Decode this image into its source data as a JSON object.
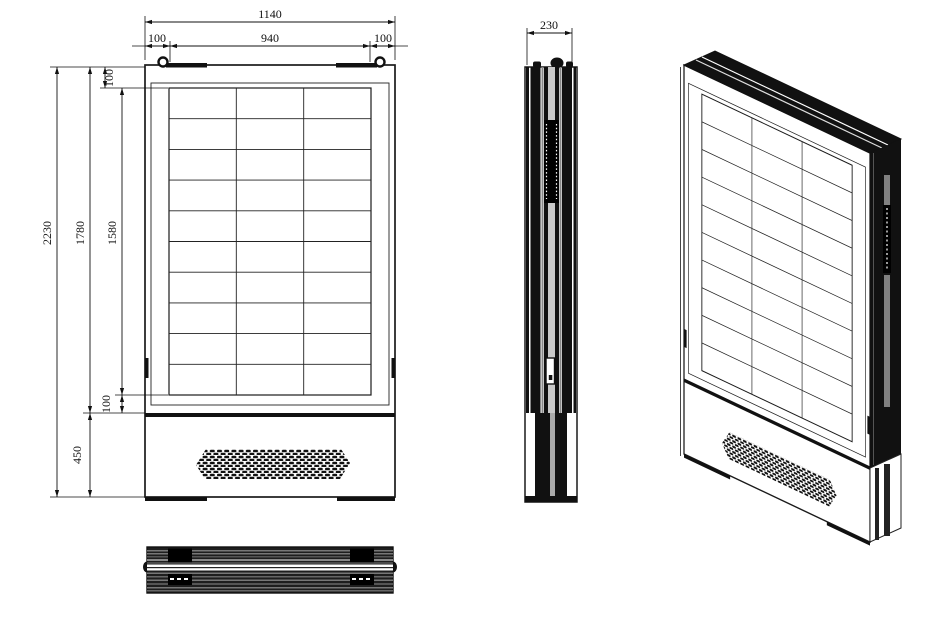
{
  "dimensions": {
    "front": {
      "overall_width": "1140",
      "panel_width": "940",
      "panel_left_margin": "100",
      "panel_right_margin": "100",
      "overall_height": "2230",
      "cabinet_height": "1780",
      "panel_height": "1580",
      "panel_top_margin": "100",
      "panel_bottom_margin": "100",
      "base_height": "450"
    },
    "side": {
      "depth": "230"
    }
  },
  "panel_grid": {
    "columns": 3,
    "rows": 10
  },
  "colors": {
    "line": "#1a1a1a",
    "fill_dark": "#111111",
    "gray_channel": "#808080",
    "background": "#ffffff"
  }
}
